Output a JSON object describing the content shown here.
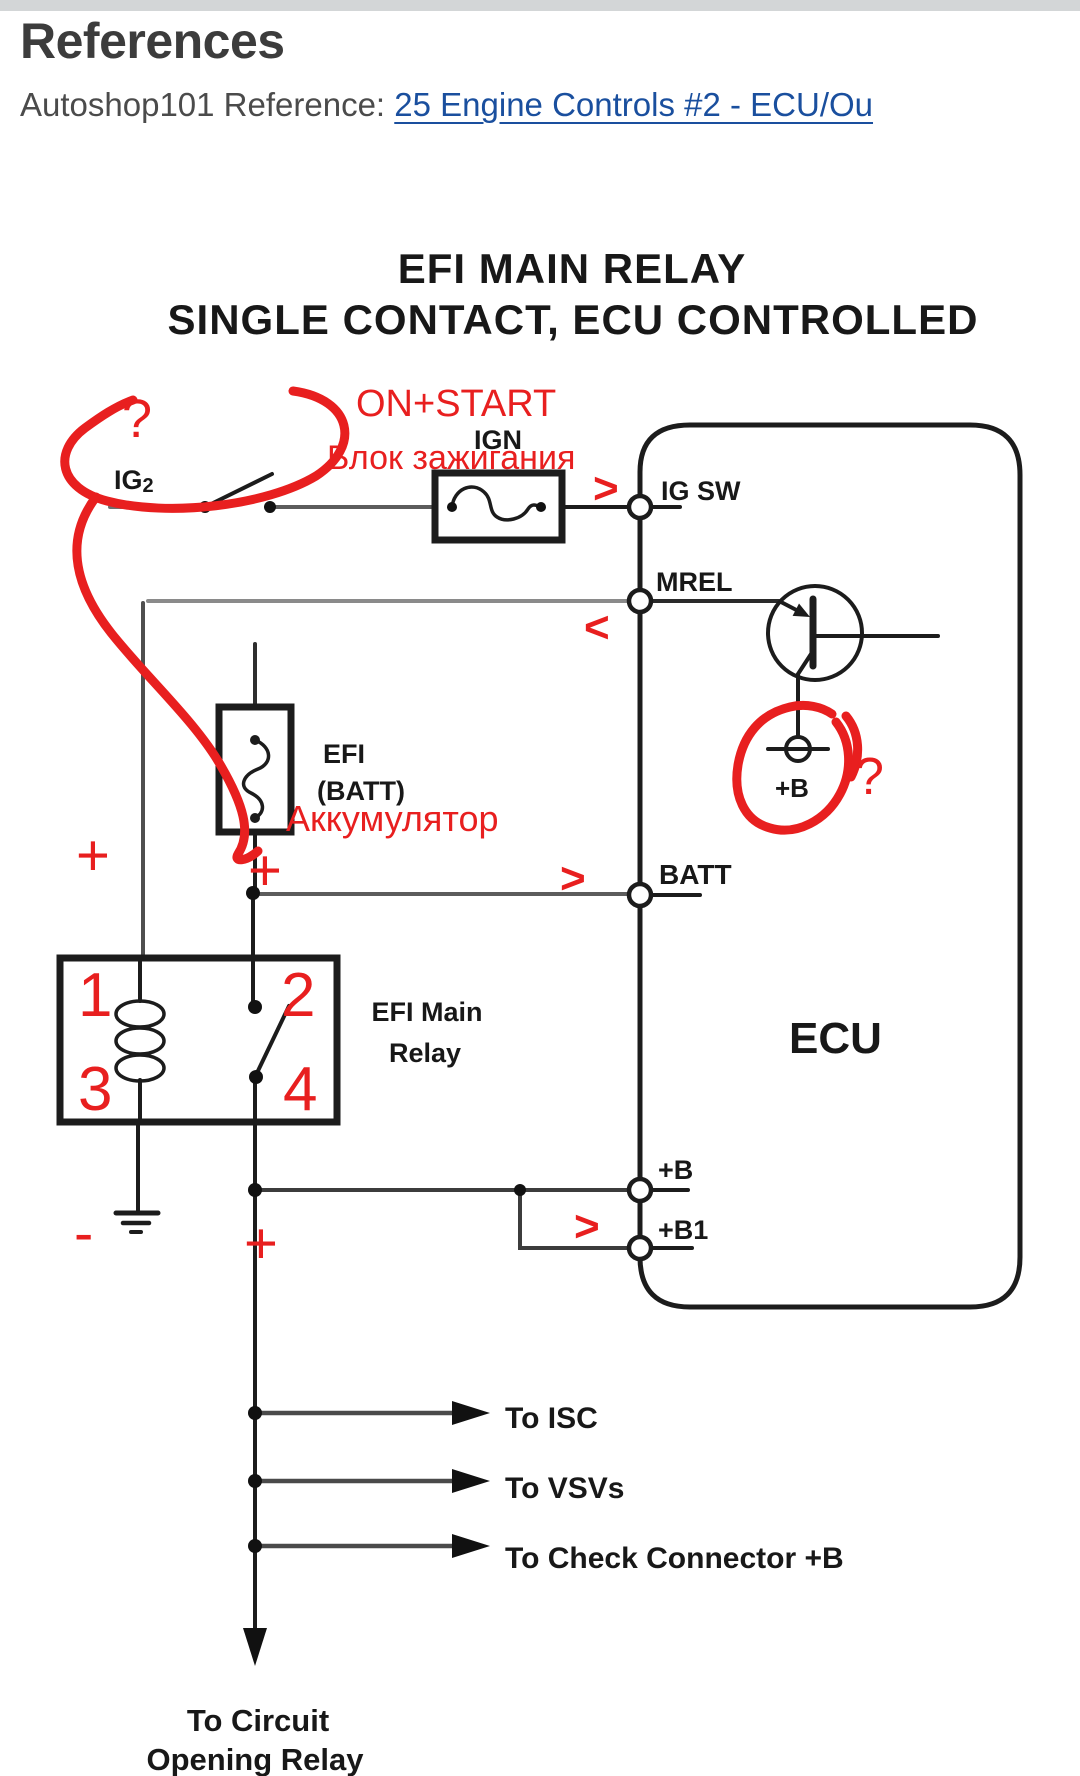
{
  "header": {
    "title": "References",
    "reference_label": "Autoshop101 Reference: ",
    "reference_link": "25 Engine Controls #2 - ECU/Ou"
  },
  "diagram": {
    "title_line1": "EFI MAIN RELAY",
    "title_line2": "SINGLE CONTACT, ECU CONTROLLED",
    "labels": {
      "ig2_base": "IG",
      "ig2_sub": "2",
      "ign": "IGN",
      "ig_sw": "IG SW",
      "mrel": "MREL",
      "efi_fuse1": "EFI",
      "efi_fuse2": "(BATT)",
      "batt": "BATT",
      "ecu": "ECU",
      "transistor_b": "+B",
      "relay1": "EFI Main",
      "relay2": "Relay",
      "plus_b": "+B",
      "plus_b1": "+B1",
      "to_isc": "To ISC",
      "to_vsvs": "To VSVs",
      "to_check": "To Check Connector +B",
      "to_circuit1": "To Circuit",
      "to_circuit2": "Opening Relay"
    },
    "annotations": {
      "question_ig2": "?",
      "on_start": "ON+START",
      "ignition_block": "Блок зажигания",
      "arrow_right_igsw": ">",
      "arrow_left_mrel": "<",
      "battery_ru": "Аккумулятор",
      "plus_left": "+",
      "plus_after_fuse": "+",
      "arrow_right_batt": ">",
      "question_b": "?",
      "pin1": "1",
      "pin2": "2",
      "pin3": "3",
      "pin4": "4",
      "minus": "-",
      "plus_pin4": "+",
      "arrow_right_b1": ">"
    }
  },
  "colors": {
    "annotation_red": "#e81f1f",
    "link_blue": "#1a4f9e",
    "ink": "#1c1c1c"
  }
}
